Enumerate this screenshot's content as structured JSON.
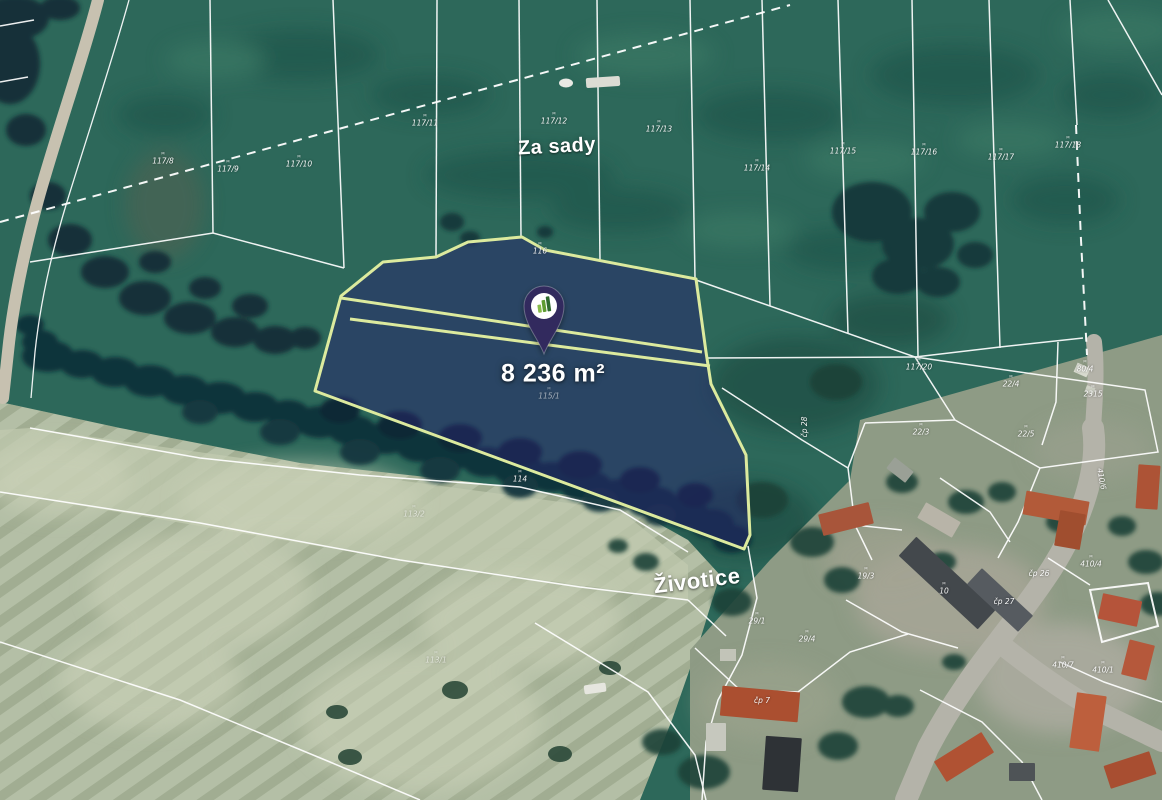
{
  "map": {
    "area_label": "8 236 m²",
    "pin": {
      "icon": "location-pin-icon",
      "logo": "bar-chart-logo-icon",
      "color": "#322a5e"
    },
    "mark_glyph": "ᴍ",
    "place_labels": [
      {
        "text": "Za sady",
        "x": 557,
        "y": 147,
        "size": 20,
        "rotate": -3
      },
      {
        "text": "Životice",
        "x": 697,
        "y": 581,
        "size": 22,
        "rotate": -7
      }
    ],
    "parcel_labels": [
      {
        "text": "117/8",
        "x": 163,
        "y": 159,
        "mark": true
      },
      {
        "text": "117/9",
        "x": 228,
        "y": 167,
        "mark": true
      },
      {
        "text": "117/10",
        "x": 299,
        "y": 162,
        "mark": true
      },
      {
        "text": "117/11",
        "x": 425,
        "y": 121,
        "mark": true
      },
      {
        "text": "117/12",
        "x": 554,
        "y": 119,
        "mark": true
      },
      {
        "text": "117/13",
        "x": 659,
        "y": 127,
        "mark": true
      },
      {
        "text": "117/14",
        "x": 757,
        "y": 166,
        "mark": true
      },
      {
        "text": "117/15",
        "x": 843,
        "y": 149,
        "mark": true
      },
      {
        "text": "117/16",
        "x": 924,
        "y": 150,
        "mark": true
      },
      {
        "text": "117/17",
        "x": 1001,
        "y": 155,
        "mark": true
      },
      {
        "text": "117/18",
        "x": 1068,
        "y": 143,
        "mark": true
      },
      {
        "text": "117/20",
        "x": 919,
        "y": 365,
        "mark": true
      },
      {
        "text": "116",
        "x": 540,
        "y": 249,
        "mark": true
      },
      {
        "text": "115/1",
        "x": 549,
        "y": 394,
        "mark": true,
        "dim": true
      },
      {
        "text": "114",
        "x": 520,
        "y": 477,
        "mark": true
      },
      {
        "text": "113/2",
        "x": 414,
        "y": 512,
        "mark": true,
        "dim": true
      },
      {
        "text": "113/1",
        "x": 436,
        "y": 658,
        "mark": true,
        "dim": true
      },
      {
        "text": "22/4",
        "x": 1011,
        "y": 382,
        "mark": true
      },
      {
        "text": "22/3",
        "x": 921,
        "y": 430,
        "mark": true
      },
      {
        "text": "22/5",
        "x": 1026,
        "y": 432,
        "mark": true
      },
      {
        "text": "čp 28",
        "x": 805,
        "y": 427,
        "rotate": -90
      },
      {
        "text": "čp 26",
        "x": 1039,
        "y": 574
      },
      {
        "text": "čp 27",
        "x": 1004,
        "y": 602
      },
      {
        "text": "19/3",
        "x": 866,
        "y": 574,
        "mark": true
      },
      {
        "text": "10",
        "x": 944,
        "y": 589,
        "mark": true
      },
      {
        "text": "29/1",
        "x": 757,
        "y": 619,
        "mark": true
      },
      {
        "text": "29/4",
        "x": 807,
        "y": 637,
        "mark": true
      },
      {
        "text": "410/4",
        "x": 1091,
        "y": 562,
        "mark": true
      },
      {
        "text": "410/6",
        "x": 1101,
        "y": 479,
        "rotate": 80
      },
      {
        "text": "410/7",
        "x": 1063,
        "y": 663,
        "mark": true
      },
      {
        "text": "410/1",
        "x": 1103,
        "y": 668,
        "mark": true
      },
      {
        "text": "80/4",
        "x": 1085,
        "y": 367,
        "mark": true
      },
      {
        "text": "2315",
        "x": 1093,
        "y": 392,
        "mark": true
      },
      {
        "text": "čp 7",
        "x": 762,
        "y": 701
      }
    ],
    "colors": {
      "highlight_fill": "#28266e",
      "highlight_outline": "#dcea9e",
      "cadastral_line": "#ffffff",
      "pin": "#322a5e"
    }
  }
}
